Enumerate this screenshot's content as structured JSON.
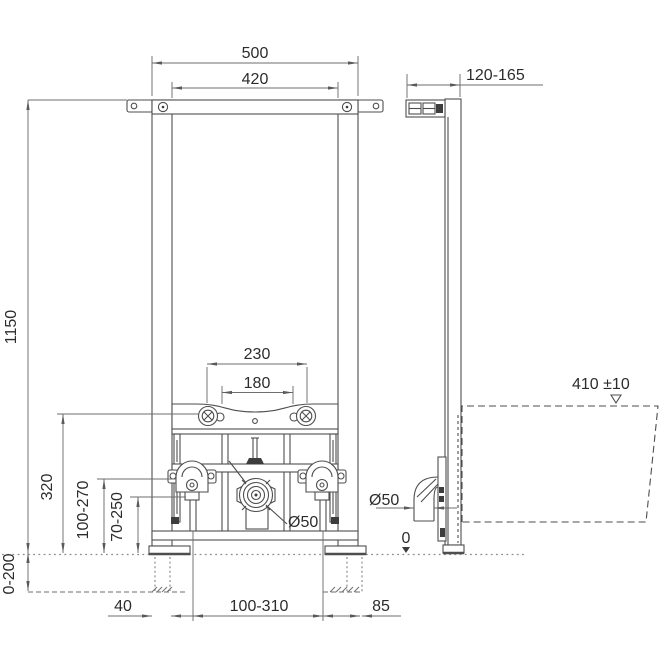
{
  "drawing": {
    "type": "installation-frame-technical-drawing",
    "line_color": "#4e4e4e",
    "dim_color": "#6e6e6e",
    "text_color": "#2c2c2c"
  },
  "dimensions": {
    "frame_width": "500",
    "anchor_width": "420",
    "wall_distance_range": "120-165",
    "frame_height": "1150",
    "foot_height_range": "0-200",
    "bolt_spacing": "230",
    "fixing_spacing": "180",
    "fixture_level": "410 ±10",
    "crossbar_height": "320",
    "supply_height_range": "100-270",
    "drain_height_range": "70-250",
    "foot_width": "40",
    "drain_lateral_range": "100-310",
    "side_clearance": "85",
    "drain_diameter_front": "Ø50",
    "drain_diameter_side": "Ø50",
    "floor_level": "0"
  }
}
